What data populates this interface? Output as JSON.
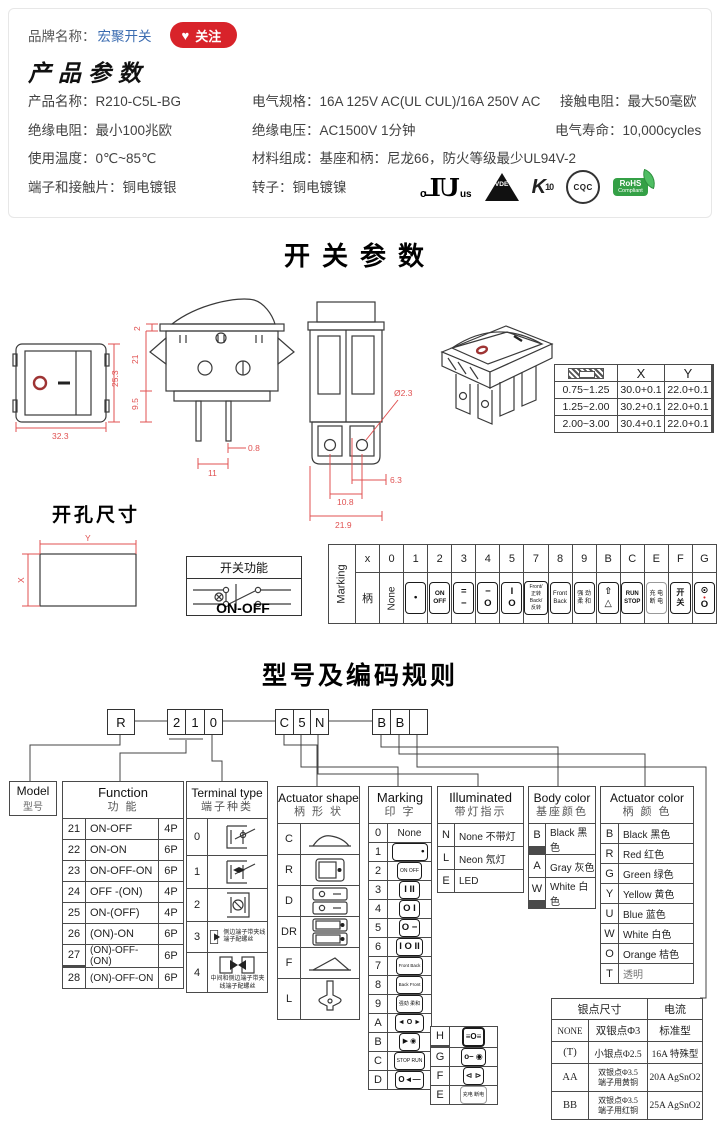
{
  "brand": {
    "label": "品牌名称：",
    "name": "宏聚开关",
    "heart": "♥",
    "follow": "关注"
  },
  "product": {
    "title": "产品参数",
    "specs": [
      {
        "label": "产品名称：",
        "value": "R210-C5L-BG"
      },
      {
        "label": "电气规格：",
        "value": "16A 125V AC(UL CUL)/16A 250V AC"
      },
      {
        "label": "接触电阻：",
        "value": "最大50毫欧"
      },
      {
        "label": "绝缘电阻：",
        "value": "最小100兆欧"
      },
      {
        "label": "绝缘电压：",
        "value": "AC1500V 1分钟"
      },
      {
        "label": "电气寿命：",
        "value": "10,000cycles"
      },
      {
        "label": "使用温度：",
        "value": "0℃~85℃"
      },
      {
        "label": "材料组成：",
        "value": "基座和柄：尼龙66，防火等级最少UL94V-2"
      },
      {
        "label": "端子和接触片：",
        "value": "铜电镀银"
      },
      {
        "label": "转子：",
        "value": "铜电镀镍"
      }
    ],
    "certs": {
      "ul_c": "c",
      "ul": "UL",
      "ul_us": "us",
      "vde": "VDE",
      "enec": "K",
      "enec_num": "10",
      "cqc": "CQC",
      "rohs": "RoHS",
      "rohs_sub": "Compliant"
    }
  },
  "switch_section": {
    "title": "开关参数",
    "front": {
      "width": "32.3",
      "height": "25.3"
    },
    "side": {
      "d_flange": "2",
      "d_body": "21",
      "d_lower": "9.5",
      "d_pin": "0.8",
      "d_pitch": "11"
    },
    "bottom": {
      "dia": "Ø2.3",
      "d1": "6.3",
      "d2": "10.8",
      "d3": "21.9"
    },
    "xy": {
      "x": "X",
      "y": "Y",
      "rows": [
        [
          "0.75~1.25",
          "30.0+0.1",
          "22.0+0.1"
        ],
        [
          "1.25~2.00",
          "30.2+0.1",
          "22.0+0.1"
        ],
        [
          "2.00~3.00",
          "30.4+0.1",
          "22.0+0.1"
        ]
      ]
    }
  },
  "cutout": {
    "title": "开孔尺寸",
    "x": "X",
    "y": "Y"
  },
  "func_box": {
    "title": "开关功能",
    "label": "ON-OFF"
  },
  "strip": {
    "label": "Marking",
    "handle": "柄",
    "none": "None",
    "codes": [
      "x",
      "0",
      "1",
      "2",
      "3",
      "4",
      "5",
      "7",
      "8",
      "9",
      "B",
      "C",
      "E",
      "F",
      "G"
    ],
    "c1": [
      "•"
    ],
    "c2": [
      "ON",
      "OFF"
    ],
    "c3": [
      "=",
      "−"
    ],
    "c4": [
      "−",
      "O"
    ],
    "c5": [
      "I",
      "O"
    ],
    "c7": [
      "Front/正转",
      "Back/反转"
    ],
    "c8": [
      "Front",
      "Back"
    ],
    "c9": [
      "强 劲",
      "柔 和"
    ],
    "cB": [
      "⇧",
      "△"
    ],
    "cC": [
      "RUN",
      "STOP"
    ],
    "cE": [
      "充 电",
      "断 电"
    ],
    "cF": [
      "开",
      "关"
    ],
    "cG": {
      "top": "⊙",
      "dot": "•",
      "o": "O"
    }
  },
  "coding": {
    "title": "型号及编码规则",
    "b_r": "R",
    "b_2": "2",
    "b_1": "1",
    "b_0": "0",
    "b_c": "C",
    "b_5": "5",
    "b_n": "N",
    "b_b1": "B",
    "b_b2": "B",
    "b_e": "",
    "model": {
      "en": "Model",
      "cn": "型号"
    },
    "function": {
      "en": "Function",
      "cn": "功  能",
      "rows": [
        [
          "21",
          "ON-OFF",
          "4P"
        ],
        [
          "22",
          "ON-ON",
          "6P"
        ],
        [
          "23",
          "ON-OFF-ON",
          "6P"
        ],
        [
          "24",
          "OFF -(ON)",
          "4P"
        ],
        [
          "25",
          "ON-(OFF)",
          "4P"
        ],
        [
          "26",
          "(ON)-ON",
          "6P"
        ],
        [
          "27",
          "(ON)-OFF-(ON)",
          "6P"
        ],
        [
          "28",
          "(ON)-OFF-ON",
          "6P"
        ]
      ]
    },
    "terminal": {
      "en": "Terminal type",
      "cn": "端子种类",
      "codes": [
        "0",
        "1",
        "2",
        "3",
        "4"
      ],
      "note3": "侧边端子带夹线端子配螺丝",
      "note4": "中间和侧边端子带夹线端子配螺丝"
    },
    "shape": {
      "en": "Actuator shape",
      "cn": "柄 形 状",
      "codes": [
        "C",
        "R",
        "D",
        "DR",
        "F",
        "L"
      ]
    },
    "marking": {
      "en": "Marking",
      "cn": "印  字",
      "rows": [
        [
          "0",
          "None"
        ],
        [
          "1",
          "•"
        ],
        [
          "2",
          "ON OFF"
        ],
        [
          "3",
          "I  II"
        ],
        [
          "4",
          "O  I"
        ],
        [
          "5",
          "O  −"
        ],
        [
          "6",
          "I O II"
        ],
        [
          "7",
          "Front Back"
        ],
        [
          "8",
          "Back Front"
        ],
        [
          "9",
          "强劲 柔和"
        ],
        [
          "A",
          "◄ O ►"
        ],
        [
          "B",
          "▶ ◉"
        ],
        [
          "C",
          "STOP RUN"
        ],
        [
          "D",
          "O◄—"
        ]
      ],
      "mini": [
        [
          "H",
          "≡O≡"
        ],
        [
          "G",
          "o– ◉"
        ],
        [
          "F",
          "⊲ ⊳"
        ],
        [
          "E",
          "充电 断电"
        ]
      ]
    },
    "illuminated": {
      "en": "Illuminated",
      "cn": "带灯指示",
      "rows": [
        [
          "N",
          "None 不带灯"
        ],
        [
          "L",
          "Neon 氖灯"
        ],
        [
          "E",
          "LED"
        ]
      ]
    },
    "body_color": {
      "en": "Body color",
      "cn": "基座颜色",
      "rows": [
        [
          "B",
          "Black 黑色"
        ],
        [
          "A",
          "Gray 灰色"
        ],
        [
          "W",
          "White 白色"
        ]
      ]
    },
    "act_color": {
      "en": "Actuator color",
      "cn": "柄 颜 色",
      "rows": [
        [
          "B",
          "Black 黑色"
        ],
        [
          "R",
          "Red  红色"
        ],
        [
          "G",
          "Green 绿色"
        ],
        [
          "Y",
          "Yellow 黄色"
        ],
        [
          "U",
          "Blue 蓝色"
        ],
        [
          "W",
          "White 白色"
        ],
        [
          "O",
          "Orange 桔色"
        ],
        [
          "T",
          "透明"
        ]
      ]
    },
    "silver": {
      "h1": "银点尺寸",
      "h2": "电流",
      "rows": [
        [
          "NONE",
          "双银点Φ3",
          "",
          "标准型"
        ],
        [
          "(T)",
          "小银点Φ2.5",
          "",
          "16A 特殊型"
        ],
        [
          "AA",
          "双银点Φ3.5",
          "端子用黄铜",
          "20A AgSnO2"
        ],
        [
          "BB",
          "双银点Φ3.5",
          "端子用红铜",
          "25A AgSnO2"
        ]
      ]
    }
  }
}
